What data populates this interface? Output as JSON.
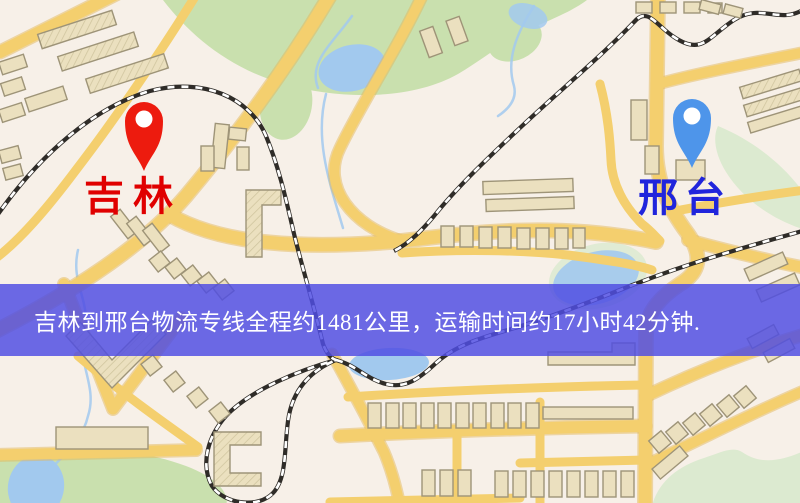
{
  "markers": {
    "origin": {
      "label": "吉林",
      "icon": "map-pin-icon",
      "pin_color": "#ed1b0e",
      "label_color": "#e00000"
    },
    "destination": {
      "label": "邢台",
      "icon": "map-pin-icon",
      "pin_color": "#4e95ea",
      "label_color": "#2025dc"
    }
  },
  "banner": {
    "text": "吉林到邢台物流专线全程约1481公里，运输时间约17小时42分钟.",
    "background_color": "#504ee2",
    "text_color": "#ffffff"
  },
  "route_info": {
    "origin": "吉林",
    "destination": "邢台",
    "service": "物流专线",
    "distance": "约1481公里",
    "duration": "约17小时42分钟"
  },
  "map_palette": {
    "background": "#f7f0e8",
    "road": "#f4cf6e",
    "road_casing": "#e3b75a",
    "building_fill": "#ebe0bf",
    "building_stroke": "#9e9478",
    "green_area": "#c9e0ae",
    "green_area_light": "#dcead0",
    "water": "#a2c9ee",
    "railway": "#2f2c28"
  }
}
